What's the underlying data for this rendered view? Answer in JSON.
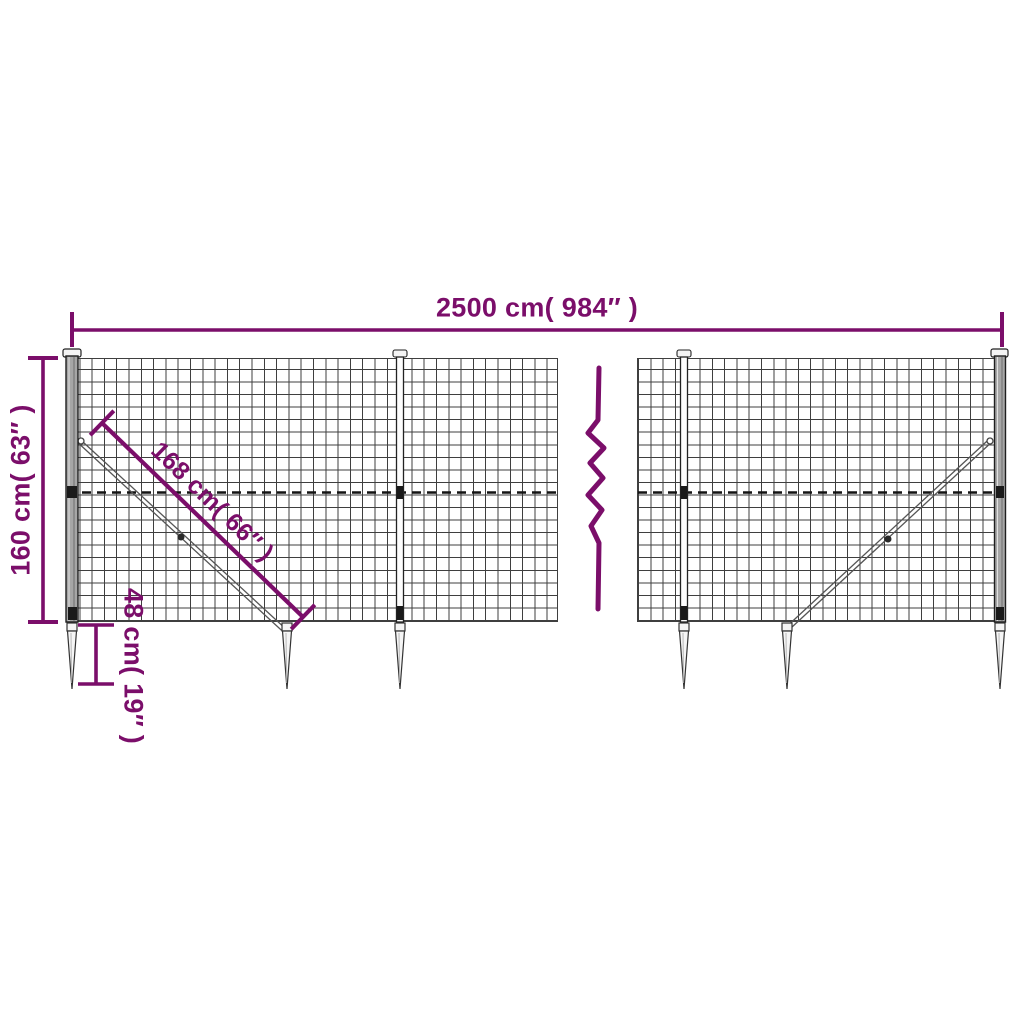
{
  "colors": {
    "accent": "#7b0e6a",
    "mesh_line": "#3f3f3f",
    "post_fill": "#a6a6a6",
    "metal_light": "#f4f4f4",
    "background": "#ffffff"
  },
  "labels": {
    "total_width": "2500 cm( 984″ )",
    "total_height": "160 cm( 63″ )",
    "brace_length": "168 cm( 66″ )",
    "anchor_depth": "48 cm( 19″ )"
  }
}
